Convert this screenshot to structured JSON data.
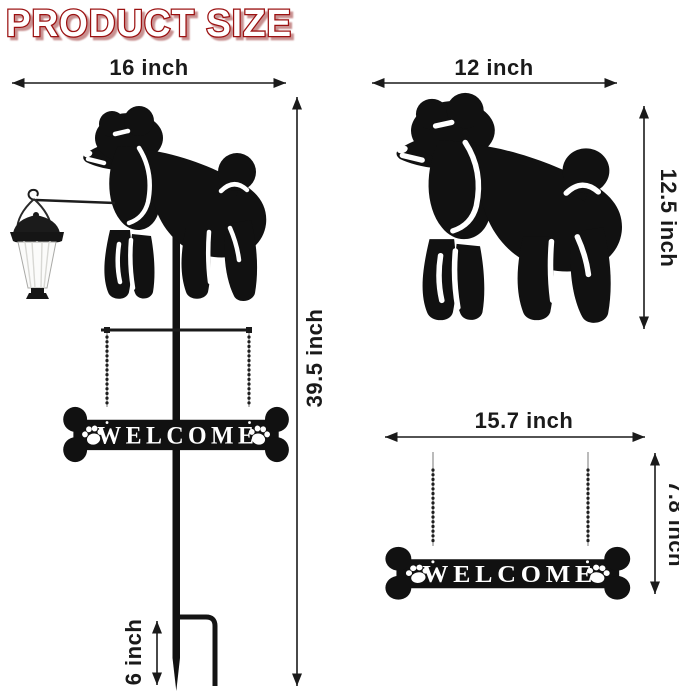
{
  "title": "PRODUCT SIZE",
  "colors": {
    "title_fill": "#ffffff",
    "title_outline": "#9b1111",
    "silhouette": "#111111",
    "background": "#ffffff"
  },
  "full_product": {
    "width": "16 inch",
    "height": "39.5 inch",
    "stake": "6 inch",
    "sign_text": "WELCOME"
  },
  "poodle": {
    "width": "12 inch",
    "height": "12.5 inch"
  },
  "sign": {
    "width": "15.7 inch",
    "height": "7.8 inch",
    "sign_text": "WELCOME"
  }
}
